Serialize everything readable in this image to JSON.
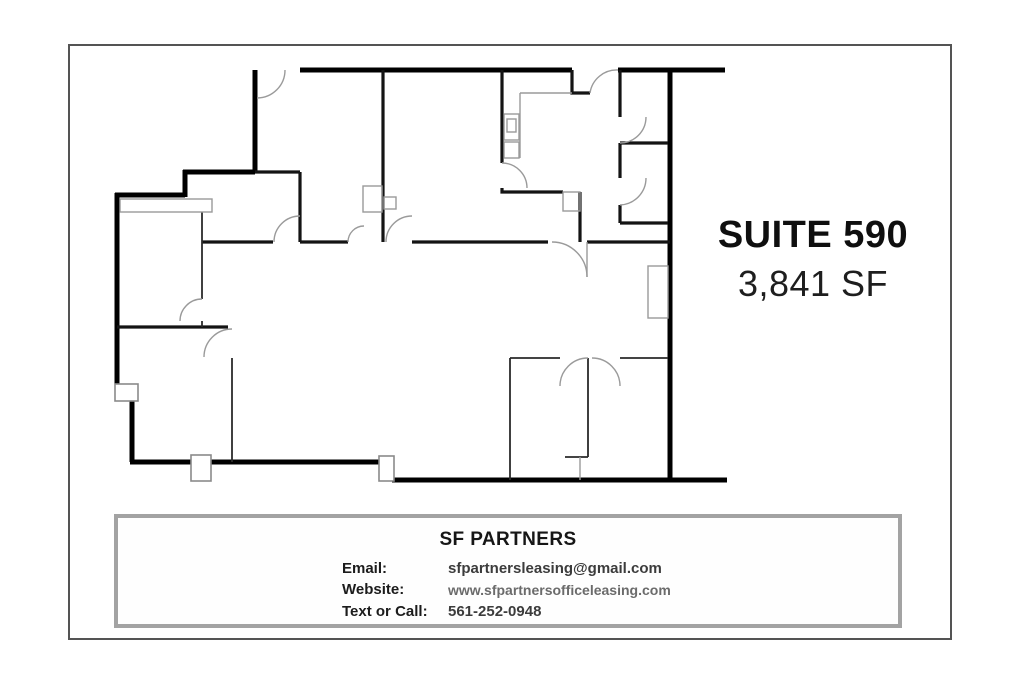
{
  "flyer": {
    "suite": {
      "title": "SUITE 590",
      "area": "3,841 SF"
    },
    "contact": {
      "company": "SF PARTNERS",
      "rows": [
        {
          "label": "Email:",
          "value": "sfpartnersleasing@gmail.com"
        },
        {
          "label": "Website:",
          "value": "www.sfpartnersofficeleasing.com"
        },
        {
          "label": "Text or Call:",
          "value": "561-252-0948"
        }
      ]
    },
    "colors": {
      "wall": "#000000",
      "door_arc": "#9a9a9a",
      "frame_border": "#545454",
      "box_border": "#a3a3a3",
      "title_text": "#0f0f0f",
      "value_text": "#3c3c3c",
      "website_text": "#6b6b6b"
    }
  }
}
